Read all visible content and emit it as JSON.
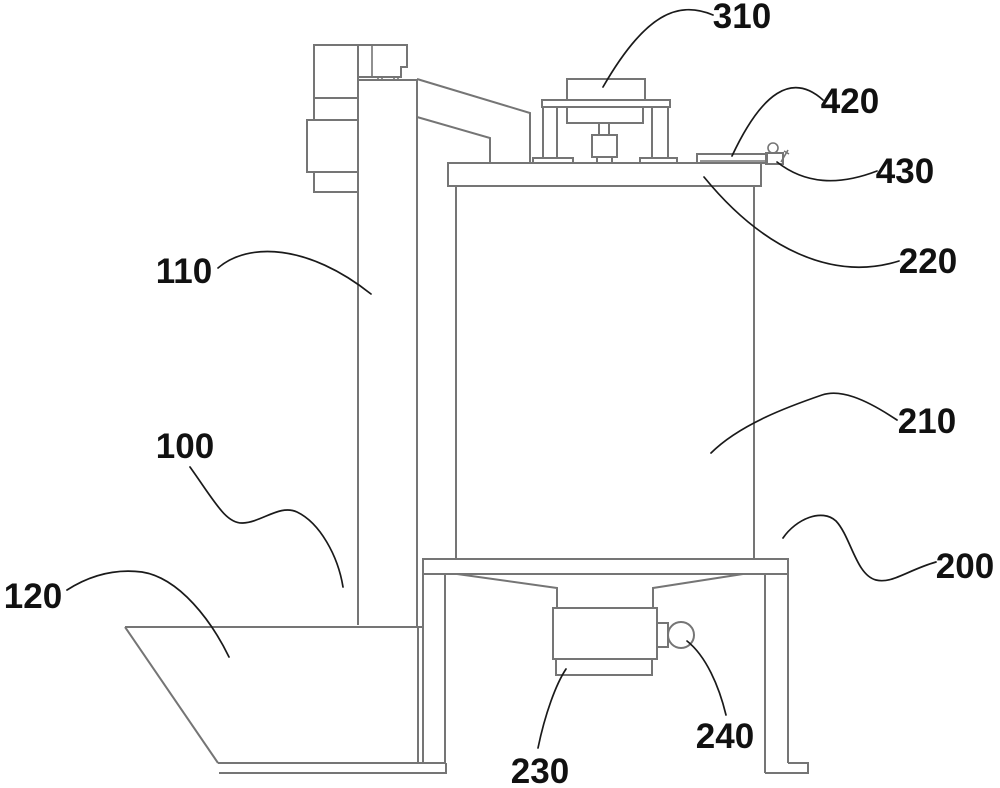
{
  "figure": {
    "kind": "patent-line-drawing",
    "colors": {
      "background": "#ffffff",
      "structure_line": "#757575",
      "leader_line": "#1a1a1a",
      "label_text": "#111111"
    },
    "labels": {
      "l100": {
        "text": "100"
      },
      "l110": {
        "text": "110"
      },
      "l120": {
        "text": "120"
      },
      "l200": {
        "text": "200"
      },
      "l210": {
        "text": "210"
      },
      "l220": {
        "text": "220"
      },
      "l230": {
        "text": "230"
      },
      "l240": {
        "text": "240"
      },
      "l310": {
        "text": "310"
      },
      "l420": {
        "text": "420"
      },
      "l430": {
        "text": "430"
      }
    }
  }
}
